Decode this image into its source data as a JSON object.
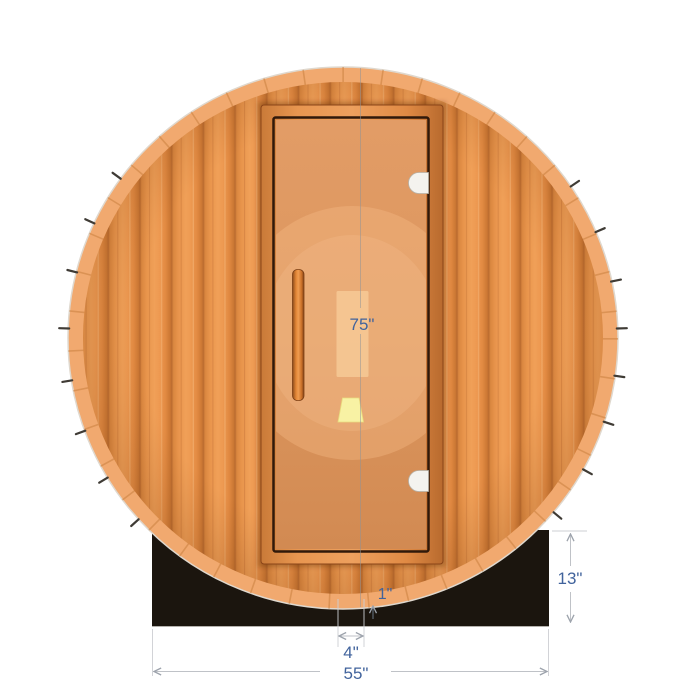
{
  "diagram": {
    "subject": "barrel-sauna-front-elevation",
    "dimension_labels": {
      "overall_height": "75\"",
      "base_height": "13\"",
      "door_center_offset": "4\"",
      "base_width": "55\"",
      "wall_thickness": "1\""
    },
    "colors": {
      "annotation_text": "#41639C",
      "annotation_line": "#BFC2C7",
      "wood_plank": "#EE9A52",
      "wood_groove": "#B96A2F",
      "barrel_rim": "#F1A96F",
      "door_frame": "#E08A44",
      "door_glass": "#DC965E",
      "stand_base": "#1B150E",
      "hinge": "#F4F3EF",
      "interior_light": "#F8F2A4",
      "background": "#FFFFFF"
    }
  }
}
